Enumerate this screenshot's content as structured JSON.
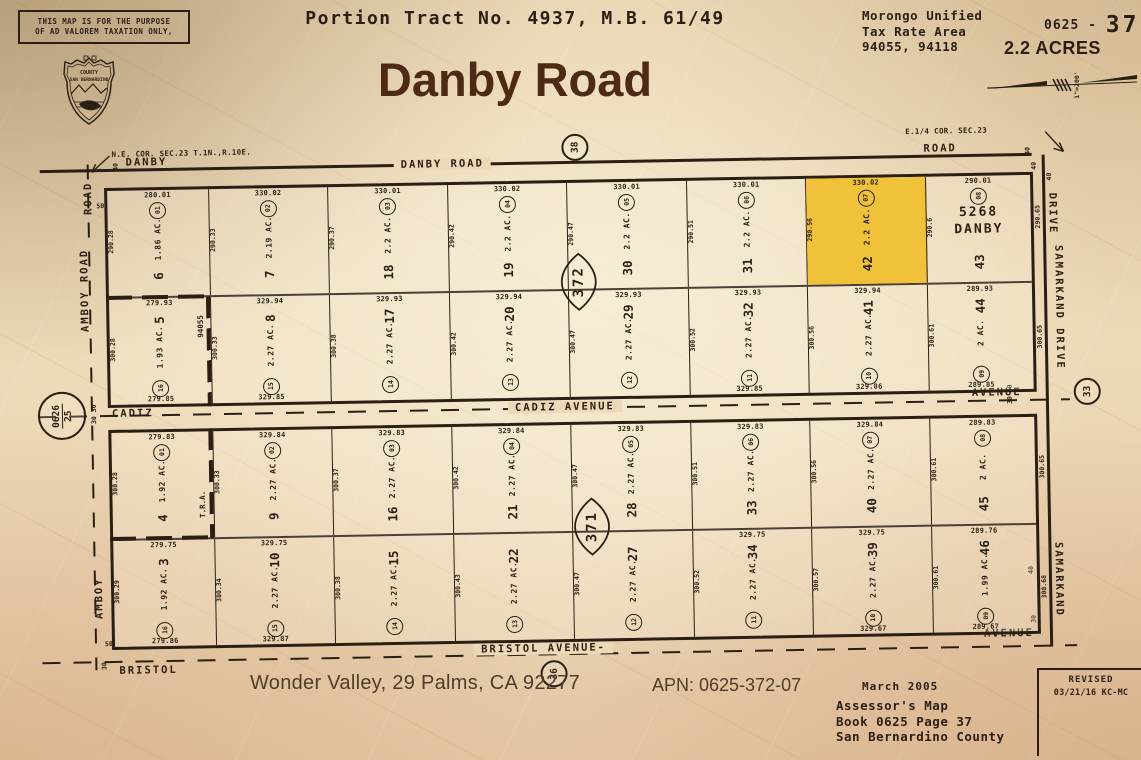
{
  "colors": {
    "paper": "#ead7b5",
    "ink": "#2a1f12",
    "title_brown": "#4d2a16",
    "highlight": "#efc23a"
  },
  "header": {
    "disclaimer": "THIS MAP IS FOR THE PURPOSE\nOF AD VALOREM TAXATION ONLY,",
    "tract_title": "Portion Tract No. 4937, M.B. 61/49",
    "main_title": "Danby Road",
    "tax_rate_area": "Morongo Unified\nTax Rate Area\n94055, 94118",
    "book_prefix": "0625 -",
    "page_number": "37",
    "acreage": "2.2 ACRES",
    "scale": "1\"=200'",
    "seal": {
      "line1": "COUNTY",
      "line2": "SAN BERNARDINO"
    }
  },
  "map": {
    "corners": {
      "ne": "N.E. COR. SEC.23 T.1N.,R.10E.",
      "e4": "E.1/4 COR. SEC.23"
    },
    "roads": {
      "danby_left": "DANBY",
      "danby_center": "DANBY ROAD",
      "danby_right": "ROAD",
      "danby_circle": "38",
      "cadiz_left": "CADIZ",
      "cadiz_center": "CADIZ AVENUE",
      "cadiz_right": "AVENUE",
      "bristol_left": "BRISTOL",
      "bristol_center": "BRISTOL AVENUE-",
      "bristol_circle": "36",
      "bristol_right": "AVENUE",
      "amboy_top": "ROAD",
      "amboy": "AMBOY ROAD",
      "amboy_bottom": "AMBOY",
      "samarkand_top": "DRIVE",
      "samarkand": "SAMARKAND DRIVE",
      "samarkand_bottom": "SAMARKAND",
      "samarkand_circle": "33",
      "ref_circle_top": "0626",
      "ref_circle_bottom": "25"
    },
    "markers": {
      "danby_left": "40",
      "danby_right": "40",
      "samarkand_top": "40",
      "samarkand_top2": "40",
      "amboy_top": "50",
      "amboy_bottom": "50",
      "cadiz_left": "30 30",
      "cadiz_right": "30 30",
      "bristol_left": "30",
      "bristol_right_40": "40",
      "bristol_right_30": "30"
    },
    "tra": {
      "b372": "94055",
      "b371": "T.R.A."
    },
    "right_dims": [
      "290.65",
      "300.65",
      "300.65",
      "300.68"
    ],
    "blocks": [
      {
        "name": "372",
        "rows": [
          {
            "cells": [
              {
                "lot": "6",
                "circle": "01",
                "acre": "1.86 AC.",
                "dim_top": "280.01",
                "dim_left": "290.28"
              },
              {
                "lot": "7",
                "circle": "02",
                "acre": "2.19 AC.",
                "dim_top": "330.02",
                "dim_left": "290.33"
              },
              {
                "lot": "18",
                "circle": "03",
                "acre": "2.2 AC.",
                "dim_top": "330.01",
                "dim_left": "290.37"
              },
              {
                "lot": "19",
                "circle": "04",
                "acre": "2.2 AC.",
                "dim_top": "330.02",
                "dim_left": "290.42"
              },
              {
                "lot": "30",
                "circle": "05",
                "acre": "2.2 AC.",
                "dim_top": "330.01",
                "dim_left": "290.47"
              },
              {
                "lot": "31",
                "circle": "06",
                "acre": "2.2 AC.",
                "dim_top": "330.01",
                "dim_left": "290.51"
              },
              {
                "lot": "42",
                "circle": "07",
                "acre": "2.2 AC.",
                "dim_top": "330.02",
                "dim_left": "290.56",
                "highlight": true
              },
              {
                "lot": "43",
                "circle": "08",
                "acre": "",
                "dim_top": "290.01",
                "dim_left": "290.6",
                "extra": "5268\nDANBY"
              }
            ]
          },
          {
            "cells": [
              {
                "lot": "5",
                "circle": "16",
                "acre": "1.93 AC.",
                "dim_top": "279.93",
                "dim_left": "300.28",
                "dim_bottom": "279.85"
              },
              {
                "lot": "8",
                "circle": "15",
                "acre": "2.27 AC.",
                "dim_top": "329.94",
                "dim_left": "300.33",
                "dim_bottom": "329.85"
              },
              {
                "lot": "17",
                "circle": "14",
                "acre": "2.27 AC.",
                "dim_top": "329.93",
                "dim_left": "300.38"
              },
              {
                "lot": "20",
                "circle": "13",
                "acre": "2.27 AC.",
                "dim_top": "329.94",
                "dim_left": "300.42"
              },
              {
                "lot": "29",
                "circle": "12",
                "acre": "2.27 AC.",
                "dim_top": "329.93",
                "dim_left": "300.47"
              },
              {
                "lot": "32",
                "circle": "11",
                "acre": "2.27 AC.",
                "dim_top": "329.93",
                "dim_left": "300.52",
                "dim_bottom": "329.85"
              },
              {
                "lot": "41",
                "circle": "10",
                "acre": "2.27 AC.",
                "dim_top": "329.94",
                "dim_left": "300.56",
                "dim_bottom": "329.86"
              },
              {
                "lot": "44",
                "circle": "09",
                "acre": "2 AC.",
                "dim_top": "289.93",
                "dim_left": "300.61",
                "dim_bottom": "289.85"
              }
            ]
          }
        ]
      },
      {
        "name": "371",
        "rows": [
          {
            "cells": [
              {
                "lot": "4",
                "circle": "01",
                "acre": "1.92 AC.",
                "dim_top": "279.83",
                "dim_left": "300.28"
              },
              {
                "lot": "9",
                "circle": "02",
                "acre": "2.27 AC.",
                "dim_top": "329.84",
                "dim_left": "300.33"
              },
              {
                "lot": "16",
                "circle": "03",
                "acre": "2.27 AC.",
                "dim_top": "329.83",
                "dim_left": "300.37"
              },
              {
                "lot": "21",
                "circle": "04",
                "acre": "2.27 AC.",
                "dim_top": "329.84",
                "dim_left": "300.42"
              },
              {
                "lot": "28",
                "circle": "05",
                "acre": "2.27 AC.",
                "dim_top": "329.83",
                "dim_left": "300.47"
              },
              {
                "lot": "33",
                "circle": "06",
                "acre": "2.27 AC.",
                "dim_top": "329.83",
                "dim_left": "300.51"
              },
              {
                "lot": "40",
                "circle": "07",
                "acre": "2.27 AC.",
                "dim_top": "329.84",
                "dim_left": "300.56"
              },
              {
                "lot": "45",
                "circle": "08",
                "acre": "2 AC.",
                "dim_top": "289.83",
                "dim_left": "300.61"
              }
            ]
          },
          {
            "cells": [
              {
                "lot": "3",
                "circle": "16",
                "acre": "1.92 AC.",
                "dim_top": "279.75",
                "dim_left": "300.29",
                "dim_bottom": "279.86"
              },
              {
                "lot": "10",
                "circle": "15",
                "acre": "2.27 AC.",
                "dim_top": "329.75",
                "dim_left": "300.34",
                "dim_bottom": "329.87"
              },
              {
                "lot": "15",
                "circle": "14",
                "acre": "2.27 AC.",
                "dim_left": "300.38"
              },
              {
                "lot": "22",
                "circle": "13",
                "acre": "2.27 AC.",
                "dim_left": "300.43"
              },
              {
                "lot": "27",
                "circle": "12",
                "acre": "2.27 AC.",
                "dim_left": "300.47"
              },
              {
                "lot": "34",
                "circle": "11",
                "acre": "2.27 AC.",
                "dim_top": "329.75",
                "dim_left": "300.52"
              },
              {
                "lot": "39",
                "circle": "10",
                "acre": "2.27 AC.",
                "dim_top": "329.75",
                "dim_left": "300.57",
                "dim_bottom": "329.67"
              },
              {
                "lot": "46",
                "circle": "09",
                "acre": "1.99 AC.",
                "dim_top": "289.76",
                "dim_left": "300.61",
                "dim_bottom": "289.67"
              }
            ]
          }
        ]
      }
    ]
  },
  "footer": {
    "location": "Wonder Valley, 29 Palms, CA  92277",
    "apn": "APN: 0625-372-07",
    "date": "March 2005",
    "assessor": "Assessor's Map\nBook 0625 Page 37\nSan Bernardino County",
    "revised_label": "REVISED",
    "revised_date": "03/21/16 KC-MC"
  }
}
